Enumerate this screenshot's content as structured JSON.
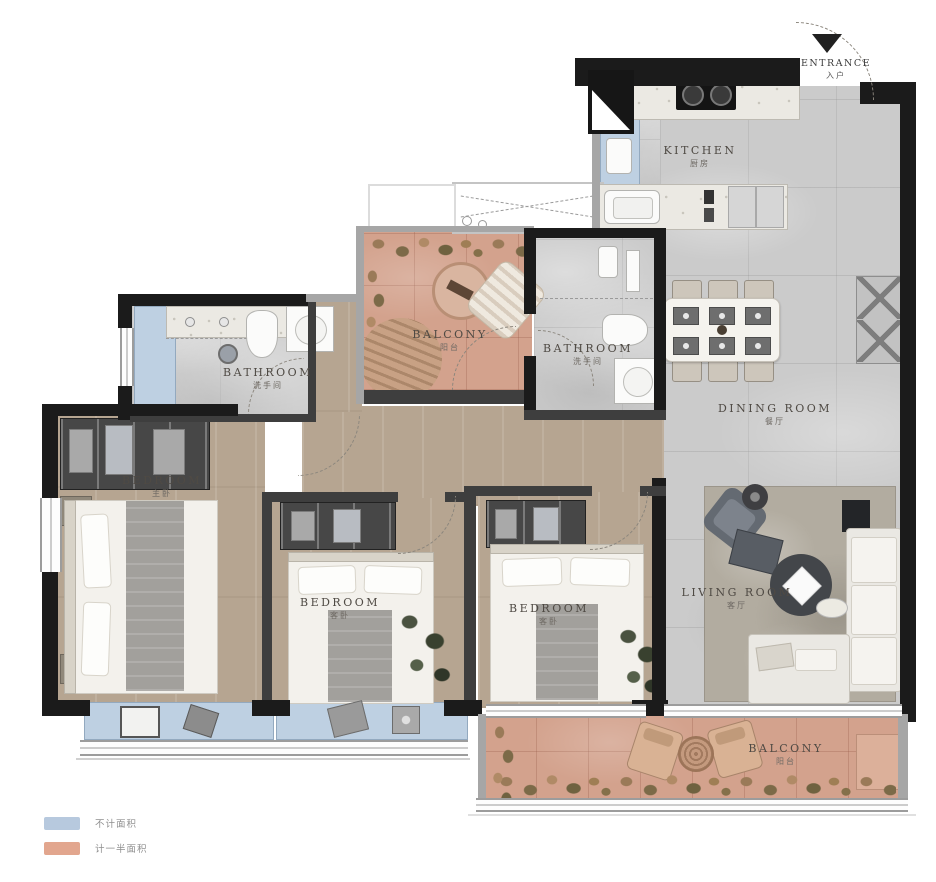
{
  "title": "apartment-floor-plan",
  "rooms": {
    "entrance": {
      "en": "ENTRANCE",
      "cn": "入户"
    },
    "kitchen": {
      "en": "KITCHEN",
      "cn": "厨房"
    },
    "dining": {
      "en": "DINING ROOM",
      "cn": "餐厅"
    },
    "living": {
      "en": "LIVING ROOM",
      "cn": "客厅"
    },
    "bathroom_left": {
      "en": "BATHROOM",
      "cn": "洗手间"
    },
    "bathroom_mid": {
      "en": "BATHROOM",
      "cn": "洗手间"
    },
    "bedroom_master": {
      "en": "BEDROOM",
      "cn": "主卧"
    },
    "bedroom_mid": {
      "en": "BEDROOM",
      "cn": "客卧"
    },
    "bedroom_right": {
      "en": "BEDROOM",
      "cn": "客卧"
    },
    "balcony_top": {
      "en": "BALCONY",
      "cn": "阳台"
    },
    "balcony_bottom": {
      "en": "BALCONY",
      "cn": "阳台"
    }
  },
  "legend": {
    "items": [
      {
        "label": "不计面积",
        "color": "#b7c9de"
      },
      {
        "label": "计一半面积",
        "color": "#e2a68e"
      }
    ]
  },
  "palette": {
    "wall": "#1b1b1b",
    "wood_floor": "#b6a591",
    "stone_floor": "#cbcbcb",
    "balcony_floor": "#d3a28d",
    "uncounted_blue": "#bed0e2"
  }
}
